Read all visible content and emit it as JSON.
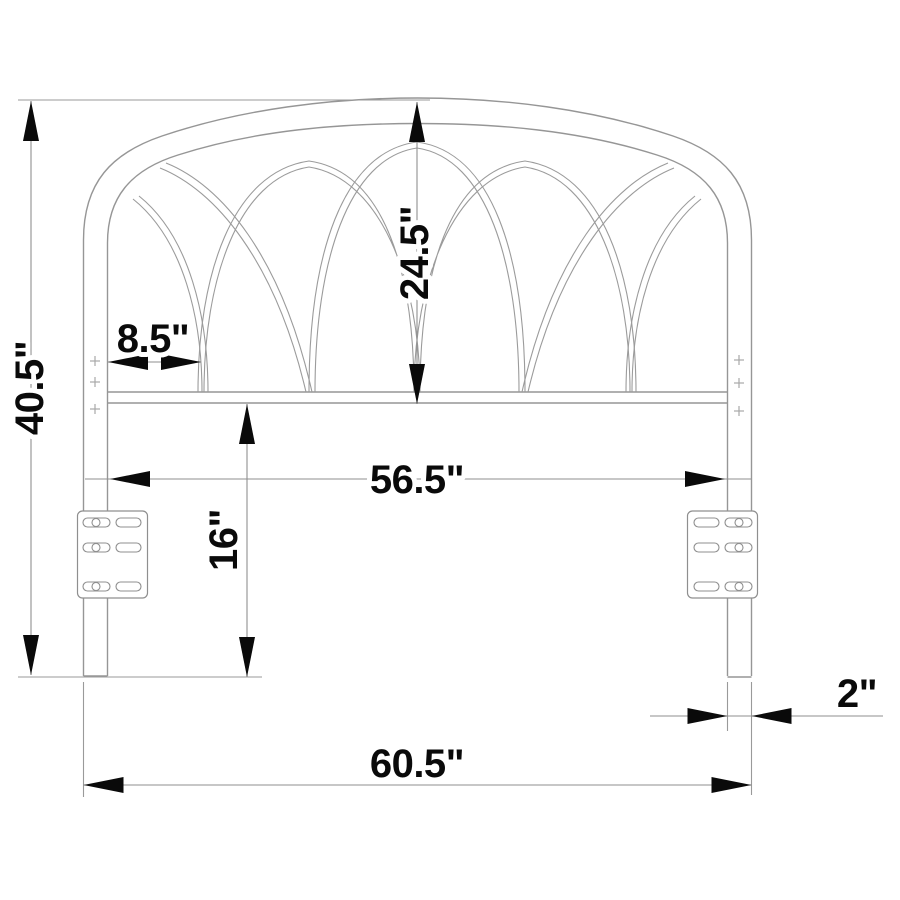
{
  "drawing": {
    "type": "technical-dimension-drawing",
    "subject": "metal headboard front elevation with arched lattice, legs and mounting brackets",
    "unit_symbol": "\"",
    "labels": {
      "overall_height": "40.5\"",
      "arch_height": "24.5\"",
      "side_arch_width": "8.5\"",
      "inner_width": "56.5\"",
      "leg_lower_height": "16\"",
      "overall_width": "60.5\"",
      "leg_width": "2\""
    },
    "colors": {
      "background": "#ffffff",
      "outline": "#969696",
      "dimension_line": "#8f8f8f",
      "ink": "#0a0a0a"
    }
  }
}
